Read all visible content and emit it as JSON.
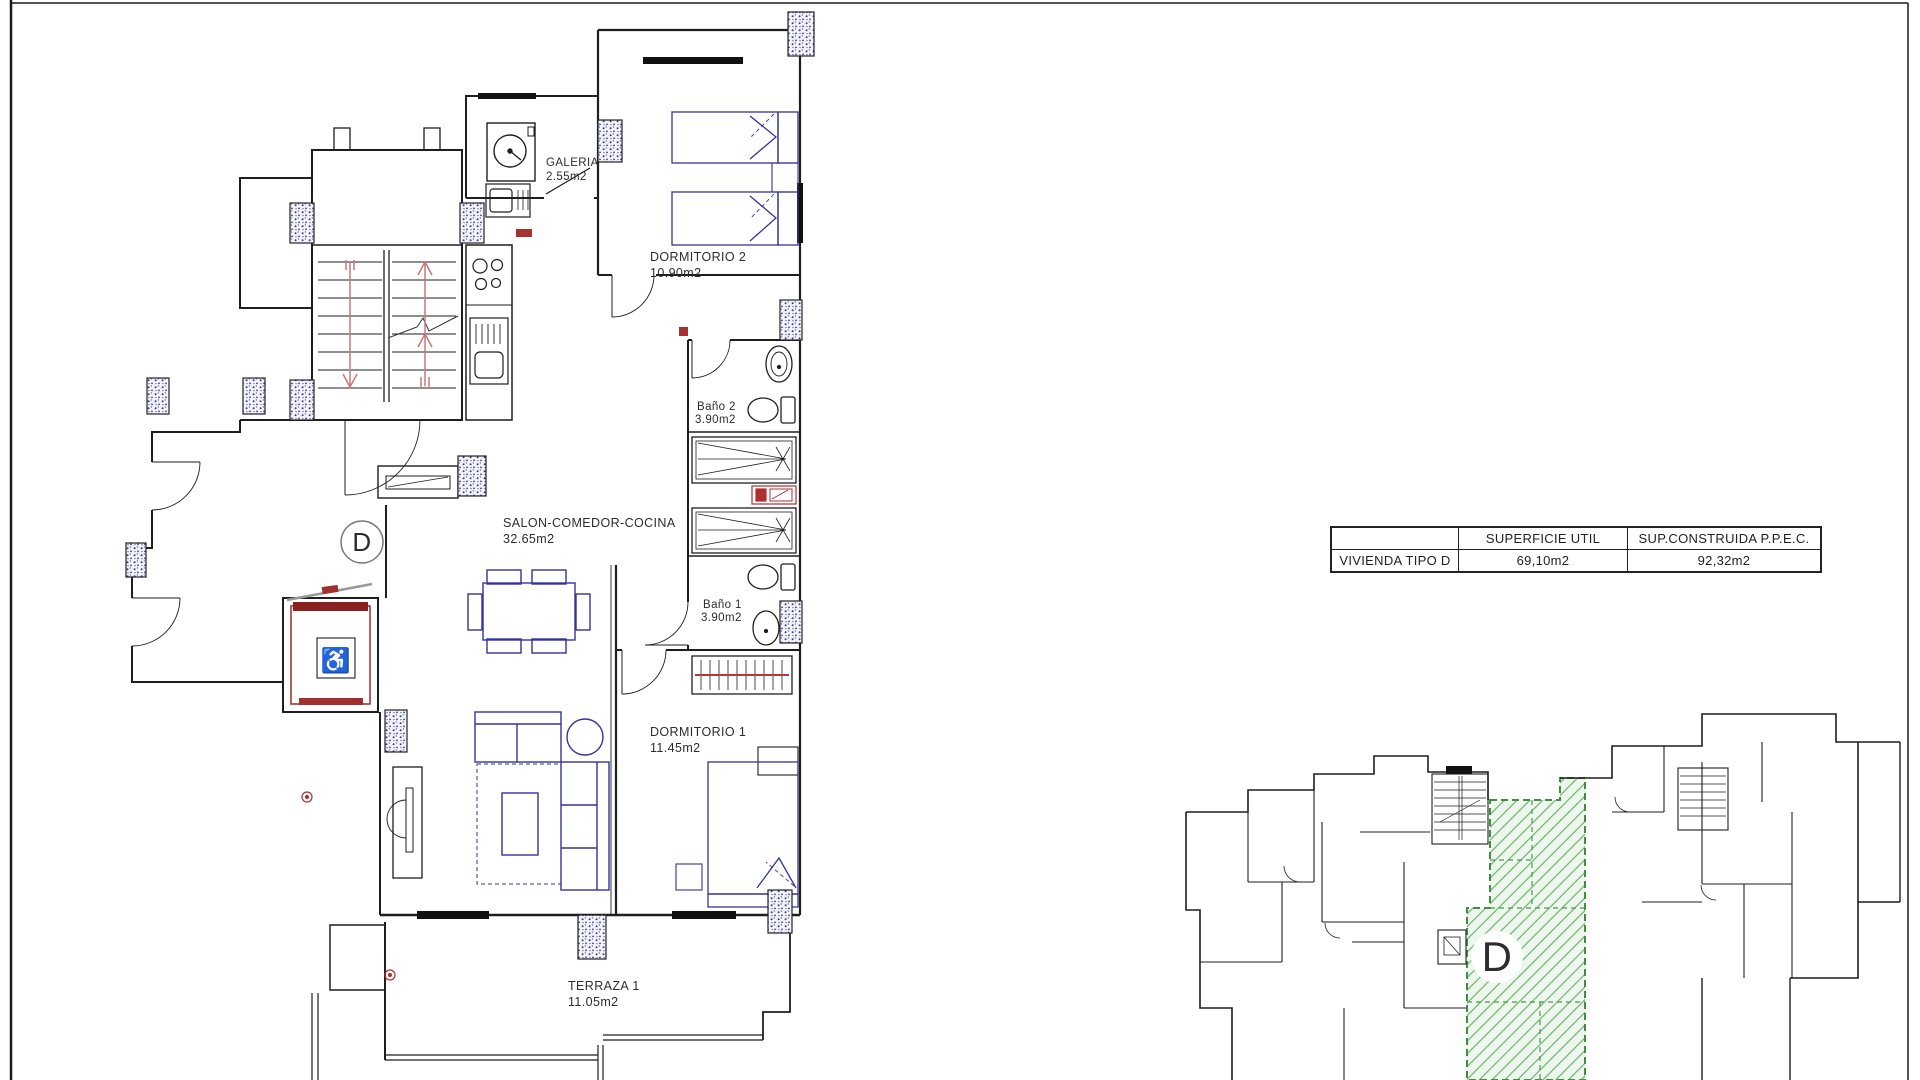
{
  "sheet": {
    "background": "#ffffff",
    "border_color": "#1a1a1a"
  },
  "colors": {
    "wall": "#1f1f1f",
    "furniture_blue": "#34349a",
    "accent_red": "#a83232",
    "stair_arrow_red": "#c87878",
    "hatch_green": "#5fae5f",
    "green_border": "#3f8f3f",
    "column_speckle": "#3c3c8e"
  },
  "floor_plan": {
    "unit_label": "D",
    "rooms": [
      {
        "id": "galeria",
        "name": "GALERIA",
        "area": "2.55m2"
      },
      {
        "id": "dormitorio2",
        "name": "DORMITORIO 2",
        "area": "10.90m2"
      },
      {
        "id": "bano2",
        "name": "Baño 2",
        "area": "3.90m2"
      },
      {
        "id": "salon",
        "name": "SALON-COMEDOR-COCINA",
        "area": "32.65m2"
      },
      {
        "id": "bano1",
        "name": "Baño 1",
        "area": "3.90m2"
      },
      {
        "id": "dormitorio1",
        "name": "DORMITORIO 1",
        "area": "11.45m2"
      },
      {
        "id": "terraza",
        "name": "TERRAZA 1",
        "area": "11.05m2"
      }
    ]
  },
  "summary_table": {
    "headers": [
      "",
      "SUPERFICIE UTIL",
      "SUP.CONSTRUIDA P.P.E.C."
    ],
    "rows": [
      [
        "VIVIENDA TIPO D",
        "69,10m2",
        "92,32m2"
      ]
    ]
  },
  "key_plan": {
    "unit_label": "D"
  }
}
